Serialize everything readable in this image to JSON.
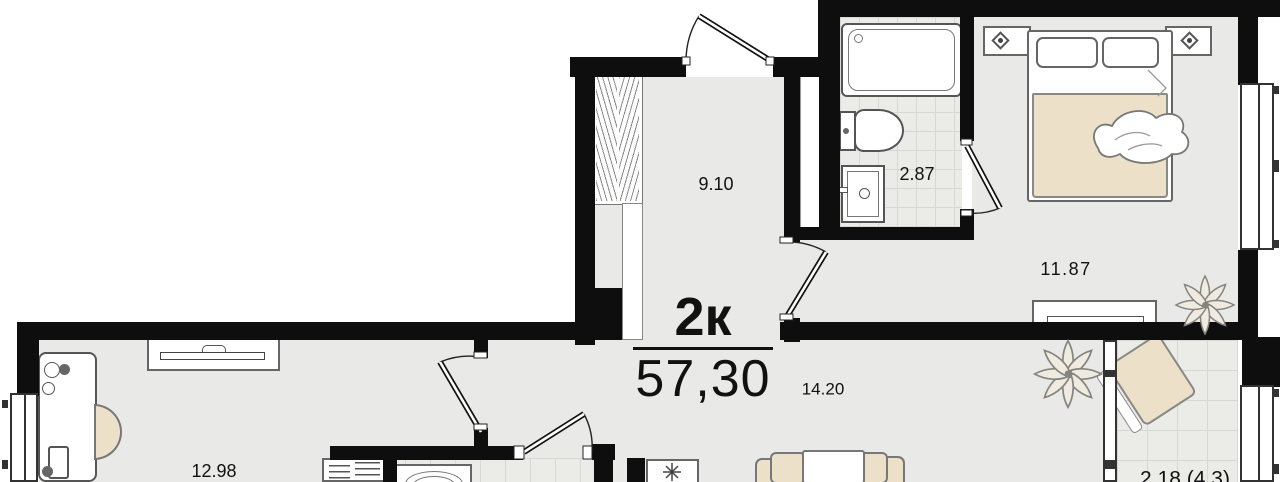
{
  "plan": {
    "unit_type": "2к",
    "total_area": "57,30",
    "rooms": {
      "hallway": "9.10",
      "bathroom": "2.87",
      "bedroom": "11.87",
      "kitchen_living": "14.20",
      "living": "12.98",
      "balcony": "2.18 (4.3)"
    },
    "palette": {
      "wall": "#0e0e0e",
      "floor": "#e9e9e7",
      "furniture_beige": "#ece0c9"
    }
  }
}
